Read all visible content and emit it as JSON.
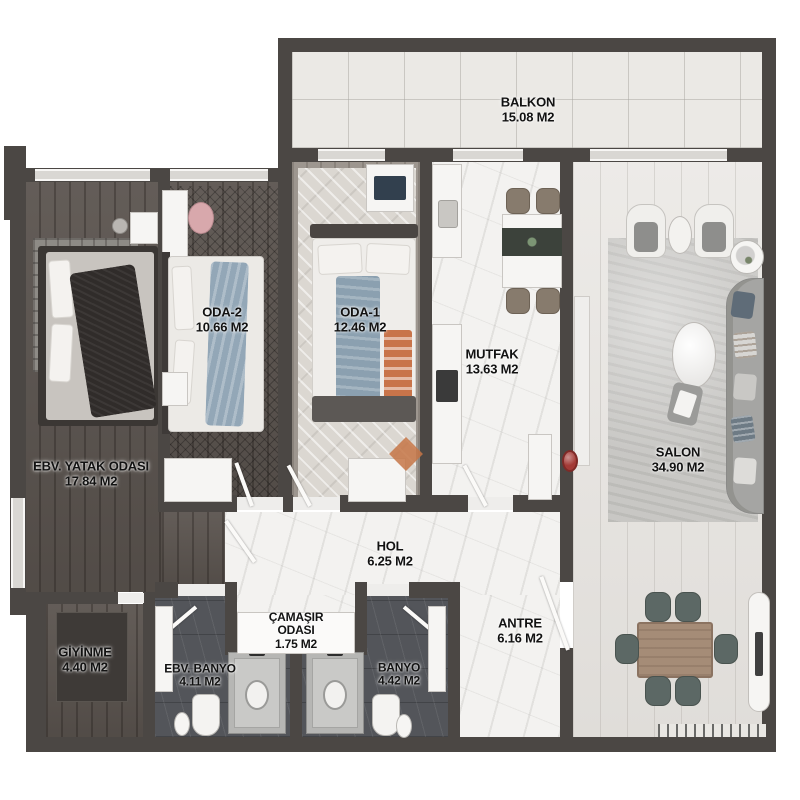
{
  "plan": {
    "type": "apartment-floor-plan",
    "area_unit": "M2"
  },
  "rooms": {
    "balkon": {
      "name": "BALKON",
      "area": "15.08 M2"
    },
    "oda2": {
      "name": "ODA-2",
      "area": "10.66 M2"
    },
    "oda1": {
      "name": "ODA-1",
      "area": "12.46 M2"
    },
    "mutfak": {
      "name": "MUTFAK",
      "area": "13.63 M2"
    },
    "salon": {
      "name": "SALON",
      "area": "34.90 M2"
    },
    "ebv_yatak": {
      "name": "EBV. YATAK ODASI",
      "area": "17.84 M2"
    },
    "hol": {
      "name": "HOL",
      "area": "6.25 M2"
    },
    "camasir": {
      "name": "ÇAMAŞIR ODASI",
      "area": "1.75 M2"
    },
    "giyinme": {
      "name": "GİYİNME",
      "area": "4.40 M2"
    },
    "ebv_banyo": {
      "name": "EBV. BANYO",
      "area": "4.11 M2"
    },
    "banyo": {
      "name": "BANYO",
      "area": "4.42 M2"
    },
    "antre": {
      "name": "ANTRE",
      "area": "6.16 M2"
    }
  },
  "colors": {
    "wall": "#4b4744",
    "balcony_tile": "#ebe9e5",
    "marble": "#f3f2f0",
    "dark_wood": "#5b544f",
    "salon_wood": "#e7e4e0",
    "bath_tile": "#53555a",
    "accent_red": "#a33a36",
    "label_text": "#121212"
  }
}
